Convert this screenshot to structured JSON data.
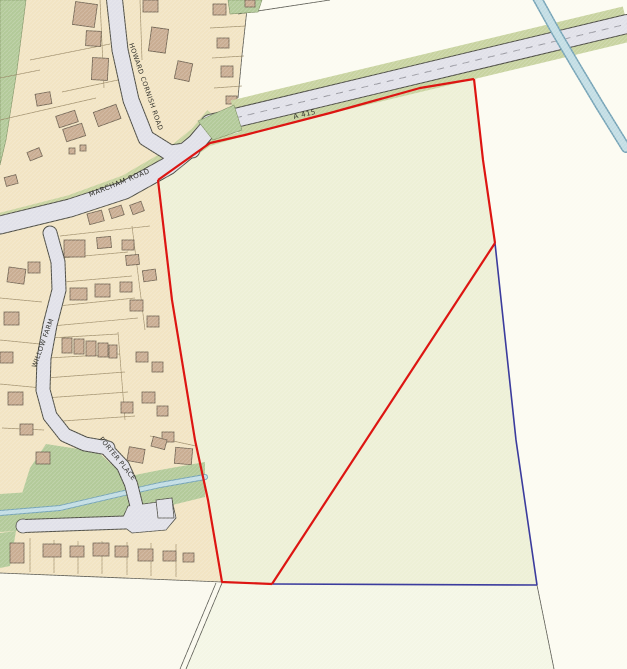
{
  "map": {
    "road_labels": {
      "marcham_road": "MARCHAM ROAD",
      "a415": "A 415",
      "howard_cornish_road": "HOWARD CORNISH ROAD",
      "willow_farm": "WILLOW FARM",
      "porter_place": "PORTER PLACE"
    }
  },
  "colors": {
    "field_white": "#fcfbf1",
    "field_light": "#f4f6e5",
    "field_bottom_left": "#faf9ee",
    "site_fill": "#edf0d6",
    "residential": "#f2e4c3",
    "green": "#b3ca99",
    "verge_green": "#c8d3a0",
    "road_fill": "#e1e1e9",
    "road_casing": "#4c4c44",
    "building": "#c9ad92",
    "building_outline": "#6e6150",
    "parcel_line": "#93825f",
    "stream_fill": "#c2dde4",
    "stream_casing": "#75a3b6",
    "boundary_red": "#dd1512",
    "boundary_blue": "#3b3b9d",
    "thin_line": "#55554d"
  }
}
